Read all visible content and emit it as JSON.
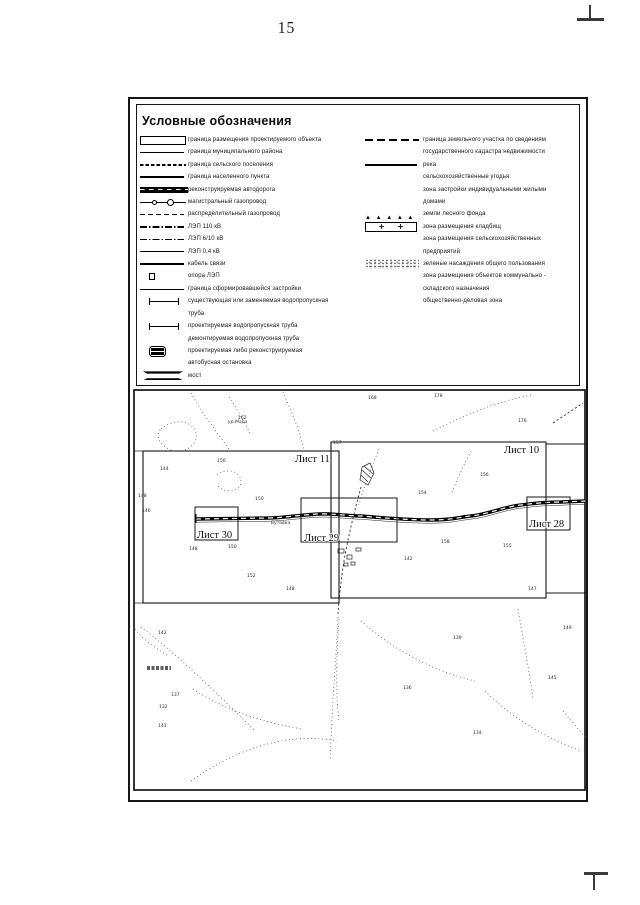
{
  "page": {
    "number": "15"
  },
  "legend": {
    "title": "Условные обозначения",
    "left_items": [
      {
        "symbol": "proj-rect",
        "label": "граница размещения проектируемого объекта"
      },
      {
        "symbol": "line-thin",
        "label": "граница муниципального района"
      },
      {
        "symbol": "line-dashdense",
        "label": "граница сельского поселения"
      },
      {
        "symbol": "line-bold",
        "label": "граница населенного пункта"
      },
      {
        "symbol": "road",
        "label": "реконструируемая автодорога"
      },
      {
        "symbol": "gas-main",
        "label": "магистральный газопровод"
      },
      {
        "symbol": "line-dashed",
        "label": "распределительный газопровод"
      },
      {
        "symbol": "line-dashdot",
        "label": "ЛЭП 110 кВ"
      },
      {
        "symbol": "line-dashdot",
        "label": "ЛЭП 6/10 кВ"
      },
      {
        "symbol": "line-thin",
        "label": "ЛЭП 0,4 кВ"
      },
      {
        "symbol": "line-cable",
        "label": "кабель связи"
      },
      {
        "symbol": "pylon",
        "label": "опора ЛЭП"
      },
      {
        "symbol": "line-thin",
        "label": "граница сформировавшейся застройки"
      },
      {
        "symbol": "pipe",
        "label": "существующая или заменяемая водопропускная\nтруба"
      },
      {
        "symbol": "pipe",
        "label": "проектируемая водопропускная труба"
      },
      {
        "symbol": "none",
        "label": "демонтируемая водопропускная труба"
      },
      {
        "symbol": "bus",
        "label": "проектируемая либо реконструируемая\nавтобусная остановка"
      },
      {
        "symbol": "bridge",
        "label": "мост"
      }
    ],
    "right_items": [
      {
        "symbol": "line-longdash",
        "label": "граница земельного участка по сведениям\nгосударственного кадастра недвижимости"
      },
      {
        "symbol": "line-river",
        "label": "река"
      },
      {
        "symbol": "none",
        "label": "сельскохозяйственные угодья"
      },
      {
        "symbol": "none",
        "label": "зона застройки индивидуальными жилыми\nдомами"
      },
      {
        "symbol": "forest",
        "label": "земли лесного фонда"
      },
      {
        "symbol": "cemetery",
        "label": "зона размещения кладбищ"
      },
      {
        "symbol": "none",
        "label": "зона размещения сельскохозяйственных\nпредприятий"
      },
      {
        "symbol": "greenery",
        "label": "зеленые насаждения общего пользования"
      },
      {
        "symbol": "none",
        "label": "зона размещения объектов коммунально -\nскладского назначения"
      },
      {
        "symbol": "none",
        "label": "общественно-деловая зона"
      }
    ]
  },
  "map": {
    "sheets": [
      {
        "label": "Лист 11",
        "x": 10,
        "y": 62,
        "w": 196,
        "h": 152,
        "lx": 162,
        "ly": 73
      },
      {
        "label": "Лист 10",
        "x": 198,
        "y": 53,
        "w": 215,
        "h": 156,
        "lx": 371,
        "ly": 64
      },
      {
        "label": "",
        "x": 413,
        "y": 55,
        "w": 58,
        "h": 149,
        "lx": 0,
        "ly": 0
      },
      {
        "label": "Лист 30",
        "x": 62,
        "y": 118,
        "w": 43,
        "h": 33,
        "lx": 64,
        "ly": 149
      },
      {
        "label": "Лист 29",
        "x": 168,
        "y": 109,
        "w": 96,
        "h": 44,
        "lx": 171,
        "ly": 152
      },
      {
        "label": "Лист 28",
        "x": 394,
        "y": 108,
        "w": 43,
        "h": 33,
        "lx": 396,
        "ly": 138
      }
    ],
    "labels": [
      {
        "text": "ур.Мара",
        "x": 95,
        "y": 34
      },
      {
        "text": "Бутовка",
        "x": 138,
        "y": 135
      }
    ],
    "elevation_marks": [
      {
        "v": "150",
        "x": 84,
        "y": 73
      },
      {
        "v": "144",
        "x": 27,
        "y": 81
      },
      {
        "v": "148",
        "x": 5,
        "y": 108
      },
      {
        "v": "146",
        "x": 9,
        "y": 123
      },
      {
        "v": "150",
        "x": 122,
        "y": 111
      },
      {
        "v": "150",
        "x": 95,
        "y": 159
      },
      {
        "v": "148",
        "x": 56,
        "y": 161
      },
      {
        "v": "152",
        "x": 114,
        "y": 188
      },
      {
        "v": "148",
        "x": 153,
        "y": 201
      },
      {
        "v": "154",
        "x": 285,
        "y": 105
      },
      {
        "v": "156",
        "x": 347,
        "y": 87
      },
      {
        "v": "158",
        "x": 308,
        "y": 154
      },
      {
        "v": "142",
        "x": 271,
        "y": 171
      },
      {
        "v": "155",
        "x": 370,
        "y": 158
      },
      {
        "v": "147",
        "x": 395,
        "y": 201
      },
      {
        "v": "178",
        "x": 301,
        "y": 8
      },
      {
        "v": "176",
        "x": 385,
        "y": 33
      },
      {
        "v": "168",
        "x": 235,
        "y": 10
      },
      {
        "v": "157",
        "x": 200,
        "y": 55
      },
      {
        "v": "162",
        "x": 105,
        "y": 30
      },
      {
        "v": "142",
        "x": 25,
        "y": 245
      },
      {
        "v": "137",
        "x": 38,
        "y": 307
      },
      {
        "v": "132",
        "x": 26,
        "y": 319
      },
      {
        "v": "141",
        "x": 25,
        "y": 338
      },
      {
        "v": "139",
        "x": 320,
        "y": 250
      },
      {
        "v": "136",
        "x": 270,
        "y": 300
      },
      {
        "v": "134",
        "x": 340,
        "y": 345
      },
      {
        "v": "145",
        "x": 415,
        "y": 290
      },
      {
        "v": "149",
        "x": 430,
        "y": 240
      }
    ]
  }
}
